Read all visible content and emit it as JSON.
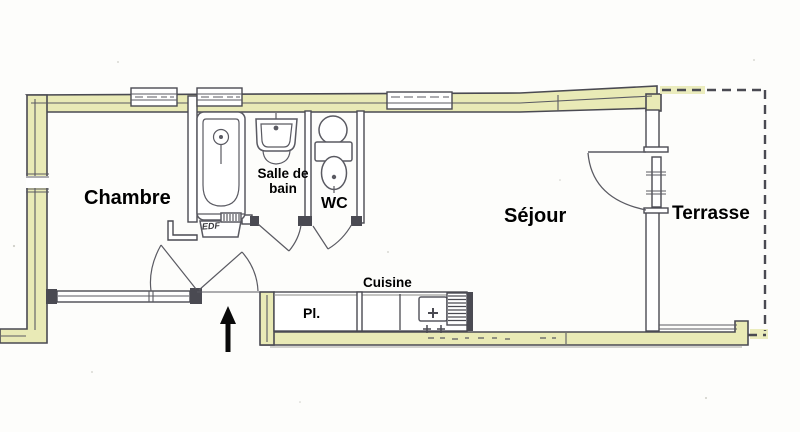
{
  "colors": {
    "wall_fill": "#e9eab6",
    "line": "#4a4a52",
    "interior_line": "#5a5a62",
    "text": "#000000",
    "background": "#fdfdfb",
    "arrow": "#0a0a0a"
  },
  "rooms": {
    "chambre": {
      "label": "Chambre"
    },
    "salle_de_bain": {
      "label": "Salle de bain"
    },
    "wc": {
      "label": "WC"
    },
    "sejour": {
      "label": "Séjour"
    },
    "terrasse": {
      "label": "Terrasse"
    }
  },
  "kitchen": {
    "label": "Cuisine",
    "closet_label": "Pl."
  },
  "utility": {
    "edf_label": "EDF"
  }
}
